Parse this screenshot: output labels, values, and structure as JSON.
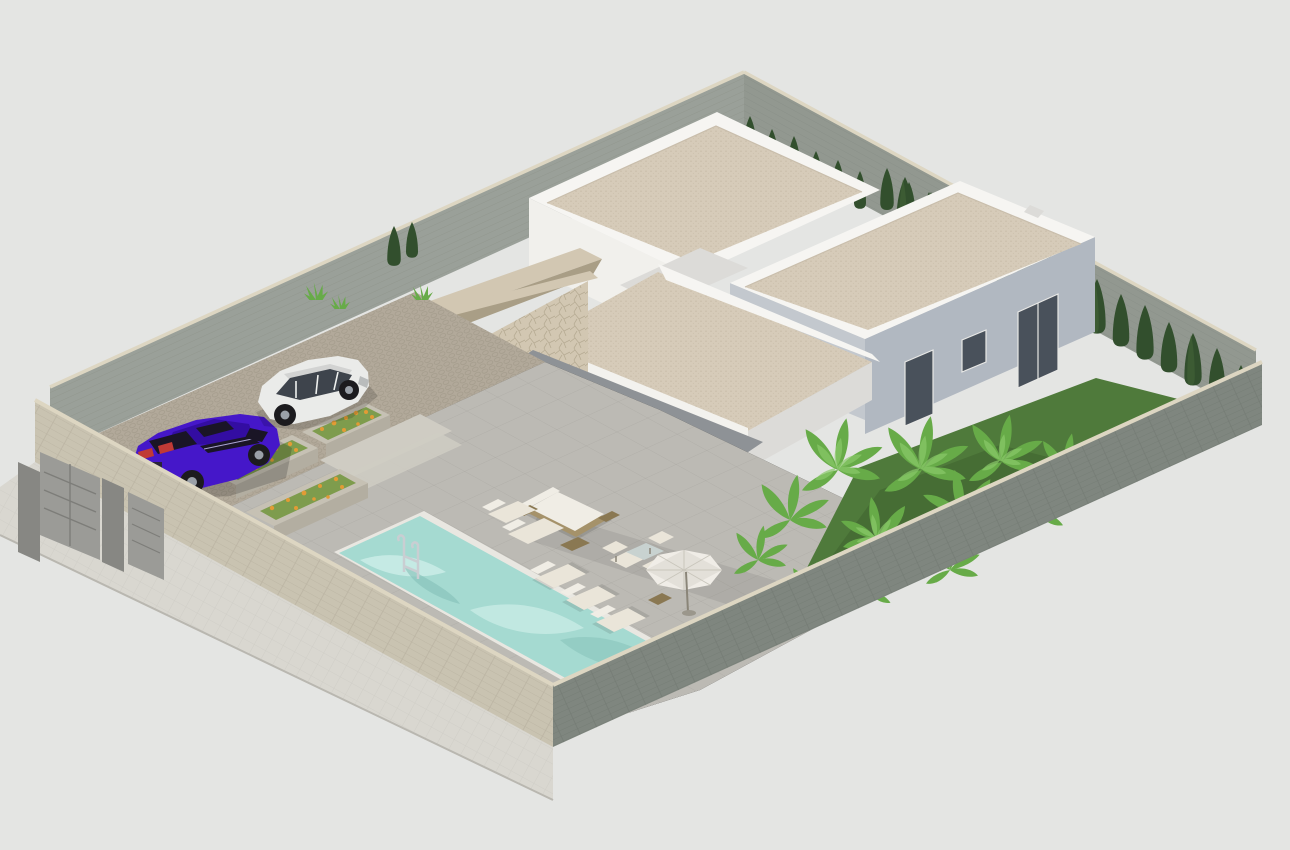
{
  "scene": {
    "title": "Isometric 3D render of a modern single-storey villa plot with swimming pool, terrace, driveway with two cars, rear flat-roof buildings and walled garden",
    "view": "aerial isometric architectural visualization",
    "elements": "main villa with stone-clad entry volume and sloped canopy over glazed porch, rattan lounge furniture, parasol, five sun loungers, rectangular pool with chrome ladder, cobbled driveway with purple sedan and white SUV, flower planters, cypress hedge rows, banana-plant garden, grey and beige perimeter walls with entrance gates"
  },
  "colors": {
    "bg": "#e4e5e3",
    "sidewalk": "#d9d7d0",
    "wall_inner": "#9aa099",
    "wall_inner2": "#929890",
    "coping": "#ddd6c2",
    "wall_front_left": "#c9c3b1",
    "wall_front_right": "#7f867f",
    "gate": "#9b9b97",
    "gate_dark": "#878783",
    "drive_cobble": "#b2a99a",
    "step": "#cfccc3",
    "terrace": "#bcbab4",
    "pool_water": "#a5dad1",
    "pool_ripple": "#cdeee8",
    "pool_deep": "#84c0b8",
    "pool_coping": "#e9e7e1",
    "grass": "#4f7a3b",
    "grass_dark": "#3f6330",
    "cypress": "#324f2d",
    "cypress_hi": "#46683a",
    "banana": "#67ab48",
    "banana_hi": "#8ac96a",
    "flower": "#e29b35",
    "flower_leaf": "#7e9c4d",
    "planter": "#c6c1b4",
    "planter_side": "#b3aea1",
    "white_lit": "#f1f0ec",
    "white_shade": "#dcdbd8",
    "parapet": "#f6f5f2",
    "gravel": "#d6cbb9",
    "bldg2_se": "#b1b8c1",
    "bldg2_sw": "#c3c8ce",
    "stone_light": "#d2c7b2",
    "stone_mid": "#c2b69f",
    "stone_dark": "#a99e86",
    "canopy": "#f3f2ee",
    "soffit": "#8e9296",
    "glass": "#646d78",
    "glass_dark": "#49515b",
    "mullion": "#e8e8e6",
    "wood": "#55422e",
    "car_purple": "#4517c9",
    "car_purple_dark": "#330da2",
    "car_window": "#1a1526",
    "car_red": "#c03a36",
    "car_white": "#eaebe9",
    "car_white_shade": "#d2d3d2",
    "suv_window": "#3e444c",
    "wheel": "#1c1b1e",
    "hub": "#9aa0a8",
    "furn_cream": "#eae5d9",
    "furn_white": "#f0ede5",
    "rattan": "#a5926a",
    "rattan_dark": "#8a7852",
    "table_glass": "#c8d2d0",
    "umbrella": "#f0ede7",
    "umbrella_shade": "#d9d6cd",
    "chrome": "#c9ced2"
  }
}
